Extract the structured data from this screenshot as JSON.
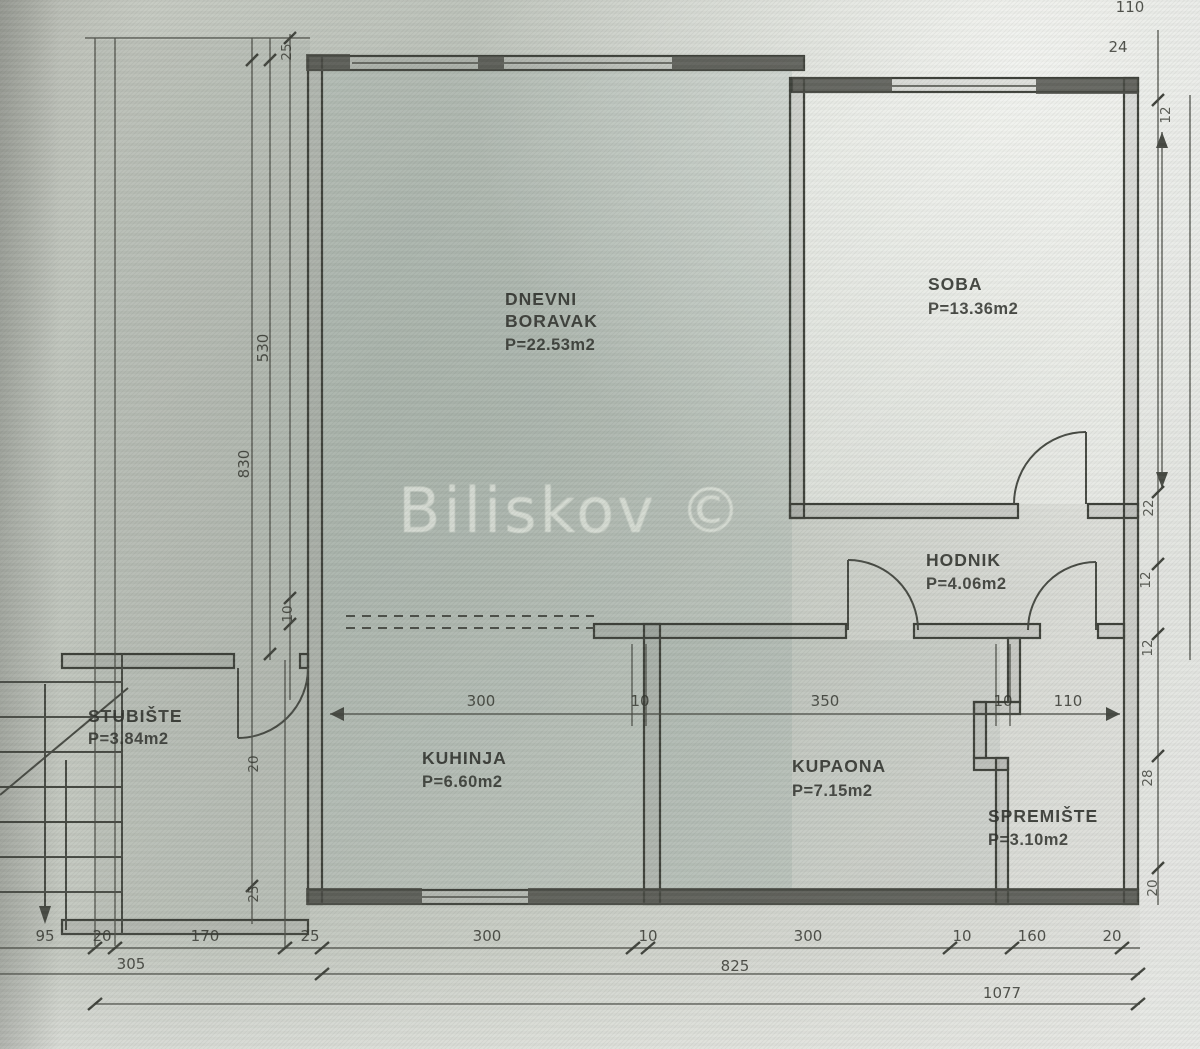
{
  "colors": {
    "ink": "#3f423b",
    "paper": "#cbcfc7",
    "watermark_text": "#d8ddd5"
  },
  "watermark": "Biliskov ©",
  "rooms": {
    "dnevni": {
      "name_line1": "DNEVNI",
      "name_line2": "BORAVAK",
      "area": "P=22.53m2"
    },
    "soba": {
      "name": "SOBA",
      "area": "P=13.36m2"
    },
    "hodnik": {
      "name": "HODNIK",
      "area": "P=4.06m2"
    },
    "kuhinja": {
      "name": "KUHINJA",
      "area": "P=6.60m2"
    },
    "kupaona": {
      "name": "KUPAONA",
      "area": "P=7.15m2"
    },
    "spremiste": {
      "name": "SPREMIŠTE",
      "area": "P=3.10m2"
    },
    "stubiste": {
      "name": "STUBIŠTE",
      "area": "P=3.84m2"
    }
  },
  "dimensions": {
    "top": {
      "w110": "110",
      "w24": "24"
    },
    "left": {
      "d25a": "25",
      "d530": "530",
      "d830": "830",
      "d10": "10",
      "d20": "20",
      "d25b": "25"
    },
    "right": {
      "r12a": "12",
      "r22": "22",
      "r12b": "12",
      "r12c": "12",
      "r28": "28",
      "r20": "20"
    },
    "middle": [
      "300",
      "10",
      "350",
      "10",
      "110"
    ],
    "bottom_row1": [
      "95",
      "20",
      "170",
      "25",
      "300",
      "10",
      "300",
      "10",
      "160",
      "20"
    ],
    "bottom_row2": [
      "305",
      "825"
    ],
    "bottom_row3": [
      "1077"
    ]
  }
}
